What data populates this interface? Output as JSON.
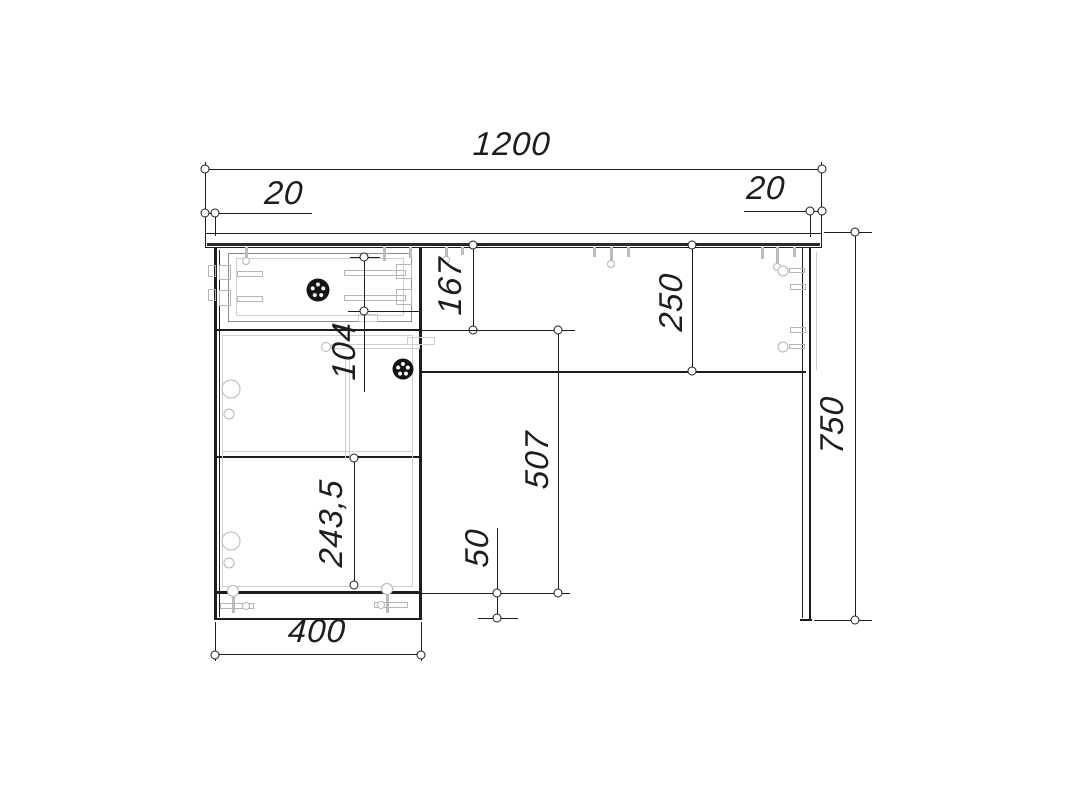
{
  "drawing": {
    "view": "desk front elevation technical drawing",
    "units": "mm",
    "dimensions": {
      "overall_width": "1200",
      "overhang_left": "20",
      "overhang_right": "20",
      "drawer_section_height": "167",
      "drawer_front_height": "104",
      "back_rail_height": "250",
      "door_opening_height": "507",
      "lower_door_height": "243,5",
      "plinth_height": "50",
      "pedestal_width": "400",
      "overall_height": "750"
    },
    "colors": {
      "line": "#1d1d1d",
      "hardware": "#bcbcbc",
      "background": "#ffffff"
    }
  }
}
